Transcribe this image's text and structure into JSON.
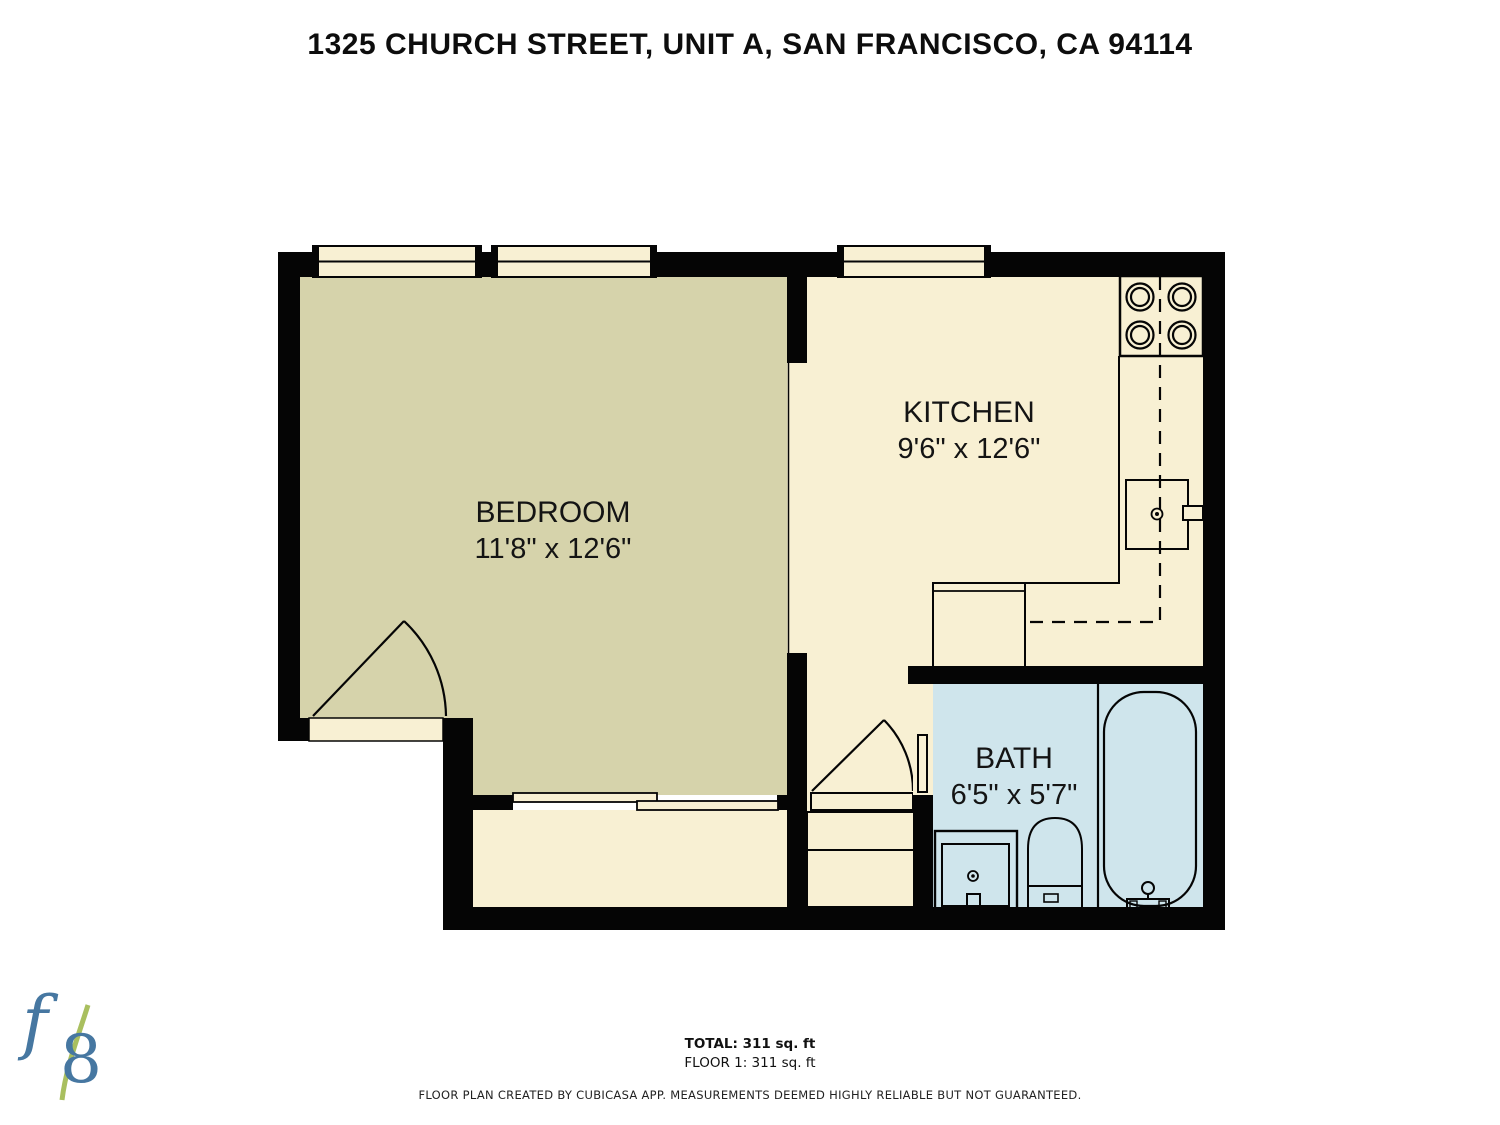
{
  "title": "1325 CHURCH STREET, UNIT A, SAN FRANCISCO, CA 94114",
  "rooms": {
    "bedroom": {
      "name": "BEDROOM",
      "dims": "11'8\" x 12'6\""
    },
    "kitchen": {
      "name": "KITCHEN",
      "dims": "9'6\" x 12'6\""
    },
    "bath": {
      "name": "BATH",
      "dims": "6'5\" x 5'7\""
    }
  },
  "summary": {
    "total": "TOTAL: 311 sq. ft",
    "floor": "FLOOR 1: 311 sq. ft"
  },
  "footer": {
    "disclaimer": "FLOOR PLAN CREATED BY CUBICASA APP. MEASUREMENTS DEEMED HIGHLY RELIABLE BUT NOT GUARANTEED."
  },
  "logo": {
    "f": "f",
    "eight": "8"
  },
  "colors": {
    "bedroom_floor": "#d6d3ab",
    "kitchen_floor": "#f8f0d3",
    "bath_floor": "#cfe5ec",
    "walls": "#050505",
    "logo_blue": "#4677a1",
    "logo_green": "#a9bf5f"
  },
  "fixtures": {
    "kitchen": [
      "stove-4-burner",
      "kitchen-sink",
      "counter",
      "upper-cabinet-dashed-line"
    ],
    "bath": [
      "vanity-sink",
      "toilet",
      "bathtub"
    ],
    "other": [
      "entry-steps",
      "sliding-door",
      "swing-doors",
      "windows"
    ]
  }
}
